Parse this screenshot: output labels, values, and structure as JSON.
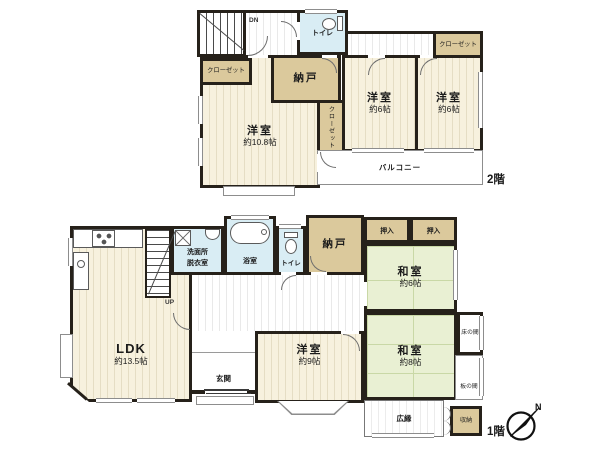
{
  "floor2": {
    "label": "2階",
    "stairs_dn": "DN",
    "toilet": {
      "name": "トイレ"
    },
    "closet_left": {
      "name": "クローゼット"
    },
    "closet_mid": {
      "name": "クローゼット"
    },
    "closet_right": {
      "name": "クローゼット"
    },
    "nando": {
      "name": "納戸"
    },
    "room_w108": {
      "name": "洋室",
      "size": "約10.8帖"
    },
    "room_w6_center": {
      "name": "洋室",
      "size": "約6帖"
    },
    "room_w6_right": {
      "name": "洋室",
      "size": "約6帖"
    },
    "balcony": {
      "name": "バルコニー"
    }
  },
  "floor1": {
    "label": "1階",
    "stairs_up": "UP",
    "ldk": {
      "name": "LDK",
      "size": "約13.5帖"
    },
    "senmen": {
      "line1": "洗面所",
      "line2": "脱衣室"
    },
    "bath": {
      "name": "浴室"
    },
    "toilet": {
      "name": "トイレ"
    },
    "nando": {
      "name": "納戸"
    },
    "oshiire_left": {
      "name": "押入"
    },
    "oshiire_right": {
      "name": "押入"
    },
    "washitsu6": {
      "name": "和室",
      "size": "約6帖"
    },
    "washitsu8": {
      "name": "和室",
      "size": "約8帖"
    },
    "tokonoma": {
      "name": "床の間"
    },
    "itanoma": {
      "name": "板の間"
    },
    "genkan": {
      "name": "玄関"
    },
    "room_w9": {
      "name": "洋室",
      "size": "約9帖"
    },
    "hiroen": {
      "name": "広縁"
    },
    "shuno": {
      "name": "収納"
    }
  },
  "compass": {
    "north": "N"
  },
  "colors": {
    "wall": "#26211a",
    "wood": "#f7f1de",
    "storage_tan": "#dbc99c",
    "wet_blue": "#d9edf4",
    "tatami_green": "#e9f0d3"
  }
}
